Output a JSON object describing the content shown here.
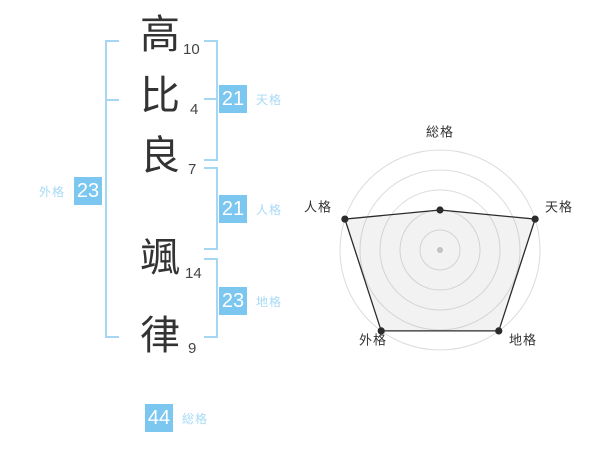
{
  "colors": {
    "badge_bg": "#7cc7f0",
    "badge_text": "#ffffff",
    "kaku_label": "#a6daf6",
    "bracket": "#a5d7f3",
    "kanji": "#333333",
    "stroke_num": "#444444",
    "radar_label": "#333333",
    "radar_grid": "#dcdcdc",
    "radar_center_dot": "#c9c9c9",
    "radar_stroke": "#2b2b2b",
    "radar_fill": "rgba(150,150,150,0.12)"
  },
  "name": {
    "characters": [
      {
        "char": "高",
        "strokes": "10"
      },
      {
        "char": "比",
        "strokes": "4"
      },
      {
        "char": "良",
        "strokes": "7"
      },
      {
        "char": "颯",
        "strokes": "14"
      },
      {
        "char": "律",
        "strokes": "9"
      }
    ]
  },
  "kaku": {
    "tenkaku": {
      "label": "天格",
      "value": "21"
    },
    "jinkaku": {
      "label": "人格",
      "value": "21"
    },
    "chikaku": {
      "label": "地格",
      "value": "23"
    },
    "gaikaku": {
      "label": "外格",
      "value": "23"
    },
    "soukaku": {
      "label": "総格",
      "value": "44"
    }
  },
  "chart_data": {
    "type": "radar",
    "title": "",
    "axes": [
      "総格",
      "天格",
      "地格",
      "外格",
      "人格"
    ],
    "values": [
      2,
      5,
      5,
      5,
      5
    ],
    "max": 5,
    "rings": 5,
    "grid": "circular-on",
    "legend": "none"
  }
}
